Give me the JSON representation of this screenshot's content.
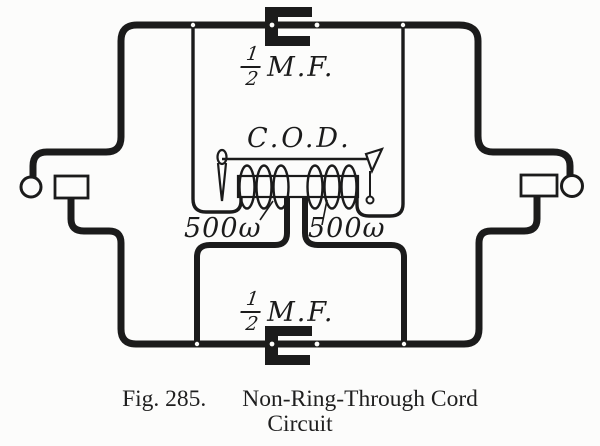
{
  "figure_caption": {
    "fig": "Fig. 285.",
    "title": "Non-Ring-Through Cord",
    "line2": "Circuit"
  },
  "diagram": {
    "coil_label": "C.O.D.",
    "windings": {
      "left": "500ω",
      "right": "500ω"
    },
    "capacitors": {
      "top": {
        "numerator": "1",
        "denominator": "2",
        "unit": "M.F."
      },
      "bottom": {
        "numerator": "1",
        "denominator": "2",
        "unit": "M.F."
      }
    },
    "colors": {
      "ink": "#1b1b1b",
      "paper": "#fcfcfb"
    }
  }
}
